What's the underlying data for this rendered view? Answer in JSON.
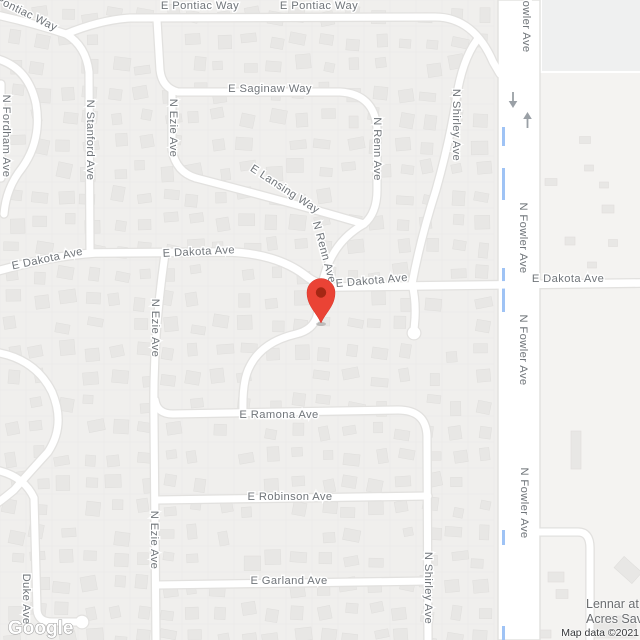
{
  "map": {
    "colors": {
      "background": "#f0efed",
      "field": "#f4f3f1",
      "field_top": "#eff0f0",
      "road_fill": "#ffffff",
      "road_casing": "#e2e1df",
      "house_fill": "#e8e7e5",
      "house_stroke": "#dfdedc",
      "parcel_line": "#ebeae8",
      "label_text": "#70757a",
      "canal": "#9fc3f5",
      "arrow": "#9aa0a6",
      "marker": "#EA4335",
      "marker_inner": "#A52714",
      "logo_stroke": "#9e9e9e"
    },
    "street_labels": [
      {
        "text": "E Pontiac Way",
        "x": 20,
        "y": 14,
        "rot": 26
      },
      {
        "text": "E Pontiac Way",
        "x": 200,
        "y": 9,
        "rot": 0
      },
      {
        "text": "E Pontiac Way",
        "x": 319,
        "y": 9,
        "rot": 0
      },
      {
        "text": "E Saginaw Way",
        "x": 270,
        "y": 92,
        "rot": 0
      },
      {
        "text": "N Fordham Ave",
        "x": 3,
        "y": 136,
        "rot": 90
      },
      {
        "text": "N Stanford Ave",
        "x": 87,
        "y": 140,
        "rot": 90
      },
      {
        "text": "N Ezie Ave",
        "x": 170,
        "y": 128,
        "rot": 90
      },
      {
        "text": "E Lansing Way",
        "x": 283,
        "y": 192,
        "rot": 33
      },
      {
        "text": "N Renn Ave",
        "x": 374,
        "y": 149,
        "rot": 90
      },
      {
        "text": "N Renn Ave",
        "x": 321,
        "y": 253,
        "rot": 75
      },
      {
        "text": "E Dakota Ave",
        "x": 48,
        "y": 262,
        "rot": -12
      },
      {
        "text": "E Dakota Ave",
        "x": 199,
        "y": 255,
        "rot": -3
      },
      {
        "text": "E Dakota Ave",
        "x": 372,
        "y": 284,
        "rot": -5
      },
      {
        "text": "E Dakota Ave",
        "x": 568,
        "y": 282,
        "rot": 0
      },
      {
        "text": "N Fowler Ave",
        "x": 523,
        "y": 17,
        "rot": 90
      },
      {
        "text": "N Fowler Ave",
        "x": 520,
        "y": 238,
        "rot": 90
      },
      {
        "text": "N Fowler Ave",
        "x": 520,
        "y": 350,
        "rot": 90
      },
      {
        "text": "N Fowler Ave",
        "x": 521,
        "y": 503,
        "rot": 90
      },
      {
        "text": "N Shirley Ave",
        "x": 453,
        "y": 125,
        "rot": 90
      },
      {
        "text": "N Shirley Ave",
        "x": 425,
        "y": 588,
        "rot": 90
      },
      {
        "text": "N Ezie Ave",
        "x": 152,
        "y": 328,
        "rot": 90
      },
      {
        "text": "N Ezie Ave",
        "x": 151,
        "y": 540,
        "rot": 90
      },
      {
        "text": "E Ramona Ave",
        "x": 279,
        "y": 418,
        "rot": 0
      },
      {
        "text": "E Robinson Ave",
        "x": 290,
        "y": 500,
        "rot": 0
      },
      {
        "text": "E Garland Ave",
        "x": 289,
        "y": 584,
        "rot": 0
      },
      {
        "text": "Duke Ave",
        "x": 23,
        "y": 599,
        "rot": 90
      }
    ],
    "one_way_arrows": [
      {
        "dir": "down",
        "x": 513,
        "y": 92
      },
      {
        "dir": "up",
        "x": 527.5,
        "y": 128
      }
    ],
    "canal": {
      "x": 503.5,
      "segments": [
        [
          127,
          146
        ],
        [
          168,
          200
        ],
        [
          268,
          312
        ],
        [
          530,
          545
        ],
        [
          626,
          640
        ]
      ]
    },
    "marker": {
      "x": 321,
      "y": 323
    }
  },
  "poi": {
    "line1": "Lennar at",
    "line2": "Acres Sav"
  },
  "attribution": {
    "text": "Map data ©2021"
  },
  "logo": {
    "text": "Google"
  }
}
